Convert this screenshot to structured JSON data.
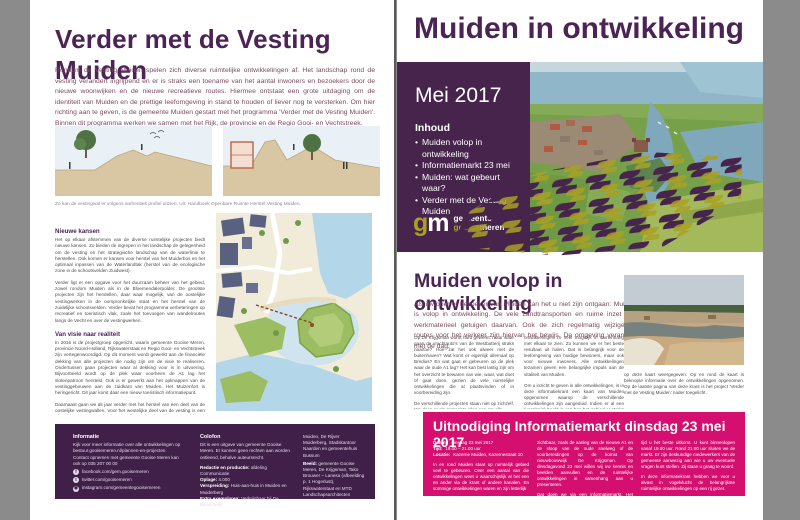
{
  "left": {
    "title": "Verder met de Vesting Muiden",
    "intro": "Rondom de Vesting Muiden spelen zich diverse ruimtelijke ontwikkelingen af. Het landschap rond de vesting verandert ingrijpend en er is straks een toename van het aantal inwoners en bezoekers door de nieuwe woonwijken en de nieuwe recreatieve routes. Hiermee ontstaat een grote uitdaging om de identiteit van Muiden en de prettige leefomgeving in stand te houden of liever nog te versterken. Om hier richting aan te geven, is de gemeente Muiden gestart met het programma 'Verder met de Vesting Muiden'. Binnen dit programma werken we samen met het Rijk, de provincie en de Regio Gooi- en Vechtstreek.",
    "fig_caption": "Zo kan de vestingwal er volgens authentiek profiel uitzien. Uit: Handboek Openbare Ruimte Herstel Vesting Muiden.",
    "s1_heading": "Nieuwe kansen",
    "s1_p1": "Het op elkaar afstemmen van de diverse ruimtelijke projecten biedt nieuwe kansen. Zo bieden de ingrepen in het landschap de gelegenheid om de vesting en het strategische landschap van de waterlinie te herstellen. Ook komen er kansen voor herstel van het Muiderbos en het optimaal inpassen van de Waterlandtak (herstel van de ecologische zone in de schootsvelden Zuidwest).",
    "s1_p2": "Verder ligt er een opgave voor het duurzaam beheer van het gebied, zowel rondom Muiden als in de Bloemendalerpolder. De grootste projecten zijn het herstellen, daar waar mogelijk, van de oostelijke vestingwerken in de oorspronkelijke staat en het herstel van de zuidelijke schootsvelden. Verder bevat het programma verbeteringen op recreatief en toeristisch vlak, zoals het toevoegen van wandelroutes langs de Vecht en over de vestingwerken.",
    "s2_heading": "Van visie naar realiteit",
    "s2_p1": "In 2016 is de projectgroep opgericht, waarin gemeente Gooise Meren, provincie Noord-Holland, Rijkswaterstaat en Regio Gooi- en Vechtstreek zijn vertegenwoordigd. Op dit moment wordt gewerkt aan de financiële dekking van alle projecten die nodig zijn om de visie te realiseren. Ondertussen gaan projecten waar al dekking voor is in uitvoering. Bijvoorbeeld wordt op de plek waar voorheen de A1 lag het slotenpatroon hersteld. Ook is er gewerkt aan het opknappen van de vestinggebouwen aan de zuidkant van Muiden. Het Muizenfort is heringericht. Dit jaar komt daar een nieuw toeristisch informatiepunt.",
    "s2_p2": "Daarnaast gaan we dit jaar verder met het herstel van een deel van de oostelijke vestingwallen. Voor het westelijke deel van de vesting is een uitwerking in twee stedenbouwkundige visies (noordwest en zuidwest) in voorbereiding om met de historie als inspiratie ook de bestaande wijken te verfraaien. Daarna wordt gekeken naar concrete maatregelen. Nadere informatie met betrekking tot Verder met de Vesting Muiden volgt nog voor september.",
    "footer": {
      "informatie_heading": "Informatie",
      "informatie_p1": "Kijk voor meer informatie over alle ontwikkelingen op bestuur.gooisemeren.nl/plannen-en-projecten",
      "informatie_p2": "Contact opnemen met gemeente Gooise Meren kan ook op 035 207 00 00",
      "social_facebook": "facebook.com/gem.gooisemeren",
      "social_twitter": "twitter.com/gooisemeren",
      "social_instagram": "instagram.com/gemeentegooisemeren",
      "colofon_heading": "Colofon",
      "colofon_p1": "Dit is een uitgave van gemeente Gooise Meren. Er kunnen geen rechten aan worden ontleend, behalve auteursrecht.",
      "redactie_label": "Redactie en productie:",
      "redactie_value": "afdeling Communicatie",
      "oplage_label": "Oplage:",
      "oplage_value": "4.000",
      "verspreiding_label": "Verspreiding:",
      "verspreiding_value": "Huis-aan-huis in Muiden en Muiderberg",
      "exemplaren_label": "Extra exemplaren:",
      "exemplaren_value": "Verkrijgbaar bij De Bibliotheek",
      "locaties": "Muiden, De Rijver Muiderberg, Stadskantoor Naarden en gemeentehuis Bussum",
      "beeld_label": "Beeld:",
      "beeld_value": "gemeente Gooise Meren, De Krijgsman, Tako Brouwer – Lanesa (afbeelding p. 1 Hogerlust), Rijkswaterstaat en MTD Landschapsarchitecten"
    }
  },
  "right": {
    "title": "Muiden in ontwikkeling",
    "issue_date": "Mei 2017",
    "inhoud_heading": "Inhoud",
    "inhoud_items": [
      "Muiden volop in ontwikkeling",
      "Informatiemarkt 23 mei",
      "Muiden: wat gebeurt waar?",
      "Verder met de Vesting Muiden"
    ],
    "logo": {
      "g": "g",
      "m": "m",
      "line1": "gemeente",
      "line2a": "gooise",
      "line2b": "meren"
    },
    "section_heading": "Muiden volop in ontwikkeling",
    "section_intro": "Als inwoner of bezoeker van Muiden kan het u niet zijn ontgaan: Muiden is volop in ontwikkeling. De vele zandtransporten en ruime inzet van werkmaterieel getuigen daarvan. Ook de zich regelmatig wijzigende routes voor het verkeer zijn hiervan het bewijs. De omgeving verandert met de dag.",
    "col1_p1": "Op De Krijgsman wordt hard gewerkt, maar waar gaan de vrachtauto's van de Westbatterij straks naartoe? Hoe zat het ook alweer met de buitenhaven? Wat komt er eigenlijk allemaal op Bredius? En wat gaat er gebeuren op de plek waar de oude A1 lag? Het kan best lastig zijn om het overzicht te bewaren van wie, waar, wat doet of gaat doen, gezien de vele ruimtelijke ontwikkelingen die al plaatsvinden of in voorbereiding zijn.",
    "col1_p2": "De verschillende projecten staan niet op zichzelf. We doen er als gemeente alles aan om alle",
    "col2_p1": "ontwikkelingen zo veel mogelijk in samenhang met elkaar te zien. Zo kunnen we er het beste resultaat uit halen. Dat is belangrijk voor de leefomgeving van huidige bewoners, maar ook voor nieuwe inwoners. Alle ontwikkelingen tezamen geven een belangrijke impuls aan de vitaliteit van Muiden.",
    "col2_p2": "Om u inzicht te geven in alle ontwikkelingen, is in deze informatiekrant een kaart van Muiden opgenomen waarop de verschillende ontwikkelingen zijn aangeduid. Indien er al een (voorlopig) beeld is van hoe het gebied er straks uit kan zien, is dit",
    "col3_p1": "op deze kaart weergegeven. Op en rond de kaart is beknopte informatie over de ontwikkelingen opgenomen. Op de laatste pagina van deze krant is het project 'Verder met de Vesting Muiden' nader toegelicht.",
    "invite": {
      "title": "Uitnodiging Informatiemarkt dinsdag 23 mei 2017",
      "datum_label": "Datum:",
      "datum_value": "dinsdag 23 mei 2017",
      "tijd_label": "Tijd:",
      "tijd_value": "19.00 – 21.00 uur",
      "locatie_label": "Locatie:",
      "locatie_value": "Kazerne Muiden, Kazernestraat 10",
      "col1_p": "In en rond Muiden staat op ruimtelijk gebied veel te gebeuren. Over een aantal van die ontwikkelingen weet u waarschijnlijk al het een en ander via de krant of andere kanalen. En sommige ontwikkelingen waren en zijn letterlijk",
      "col2_p1": "zichtbaar, zoals de aanleg van de nieuwe A1 en de sloop van de oude snelweg of de voorbereidingen op de komst van nieuwbouwwijk De Krijgsman. Op dinsdagavond 23 mei willen wij uw kennis en beelden aanvullen en de ruimtelijke ontwikkelingen in samenhang aan u presenteren.",
      "col2_p2": "Dat doen we via een informatiemarkt. Het betreft een inloopbijeenkomst. U kunt dus zelf bepalen welke",
      "col3_p1": "tijd u het beste uitkomt. U kunt binnenlopen vanaf 19.00 uur. Rond 21.00 uur sluiten we de markt. Er zijn deskundige medewerkers van de gemeente aanwezig aan wie u uw eventuele vragen kunt stellen. Zij staan u graag te woord.",
      "col3_p2": "In deze informatiekrant hebben we voor u alvast in vogelvlucht de belangrijkste ruimtelijke ontwikkelingen op een rij gezet."
    }
  },
  "colors": {
    "brand_purple": "#46244c",
    "title_purple": "#4b2455",
    "brand_olive": "#a9a023",
    "invite_pink": "#d40f6f",
    "intro_maroon": "#7d4a5f",
    "background_gray": "#8b8b8b"
  }
}
